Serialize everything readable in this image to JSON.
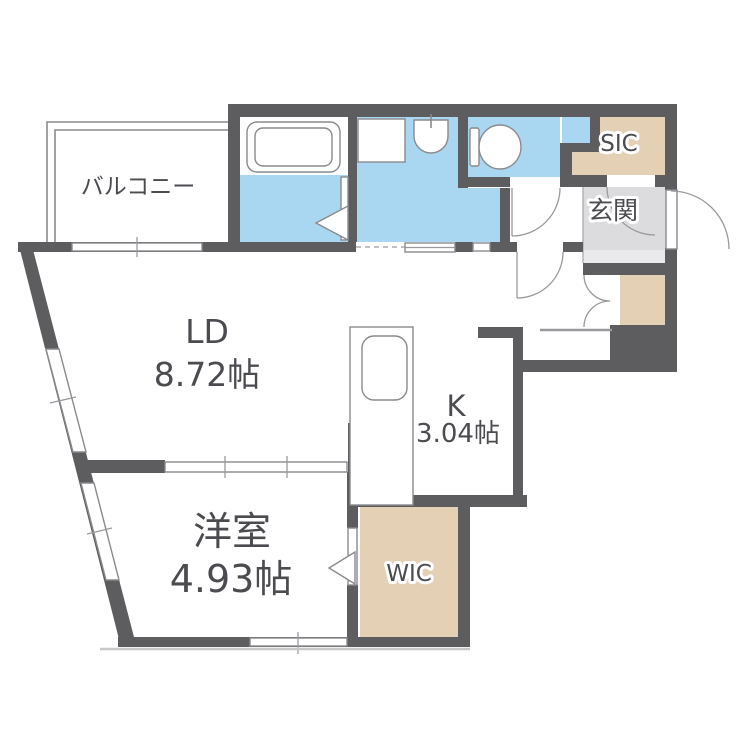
{
  "title": "1LDK floor plan",
  "colors": {
    "wall": "#5d5d60",
    "wet_area": "#a9d7f1",
    "storage": "#e4d0b5",
    "entrance_floor": "#dcdcde",
    "entrance_step": "#eaeaec",
    "line": "#8a8a8e",
    "text": "#4b4b50",
    "fixture": "#ffffff"
  },
  "rooms": {
    "balcony": {
      "label": "バルコニー"
    },
    "living_dining": {
      "label": "LD",
      "area": "8.72帖"
    },
    "kitchen": {
      "label": "K",
      "area": "3.04帖"
    },
    "western_room": {
      "label": "洋室",
      "area": "4.93帖"
    },
    "wic": {
      "label": "WIC"
    },
    "sic": {
      "label": "SIC"
    },
    "entrance": {
      "label": "玄関"
    }
  }
}
